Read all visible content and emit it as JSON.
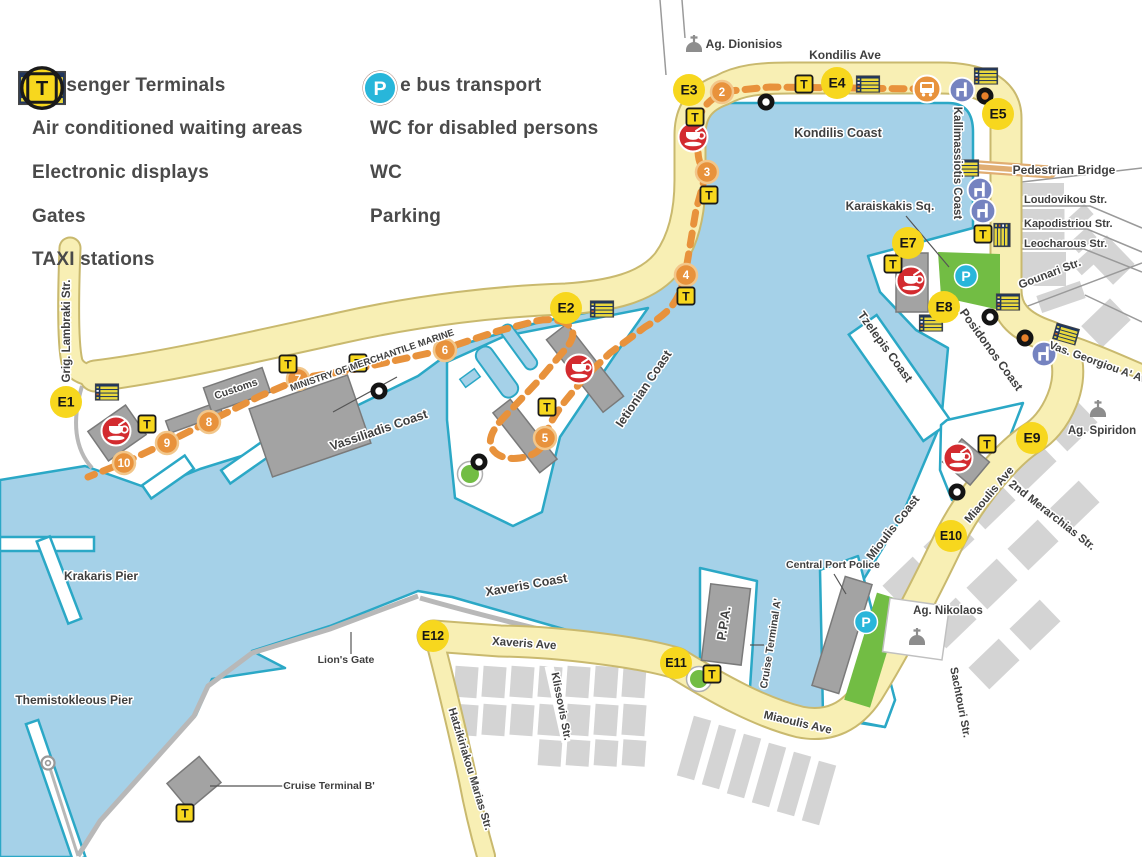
{
  "legend": {
    "left": [
      {
        "icon": "terminal",
        "label": "Passenger Terminals"
      },
      {
        "icon": "waiting",
        "label": "Air conditioned waiting areas"
      },
      {
        "icon": "display",
        "label": "Electronic displays"
      },
      {
        "icon": "gate",
        "label": "Gates"
      },
      {
        "icon": "taxi",
        "label": "TAXI stations"
      }
    ],
    "right": [
      {
        "icon": "bus",
        "label": "Free bus transport"
      },
      {
        "icon": "wc_disabled",
        "label": "WC for disabled persons"
      },
      {
        "icon": "wc",
        "label": "WC"
      },
      {
        "icon": "parking",
        "label": "Parking"
      }
    ],
    "gate_symbol": "E",
    "taxi_symbol": "T",
    "parking_symbol": "P"
  },
  "map": {
    "gates": [
      {
        "id": "E1",
        "x": 66,
        "y": 402
      },
      {
        "id": "E2",
        "x": 566,
        "y": 308
      },
      {
        "id": "E3",
        "x": 689,
        "y": 90
      },
      {
        "id": "E4",
        "x": 837,
        "y": 83
      },
      {
        "id": "E5",
        "x": 998,
        "y": 114
      },
      {
        "id": "E7",
        "x": 908,
        "y": 243
      },
      {
        "id": "E8",
        "x": 944,
        "y": 307
      },
      {
        "id": "E9",
        "x": 1032,
        "y": 438
      },
      {
        "id": "E10",
        "x": 951,
        "y": 536
      },
      {
        "id": "E11",
        "x": 676,
        "y": 663
      },
      {
        "id": "E12",
        "x": 433,
        "y": 636
      }
    ],
    "route_stops": [
      {
        "n": "2",
        "x": 722,
        "y": 92
      },
      {
        "n": "3",
        "x": 707,
        "y": 172
      },
      {
        "n": "4",
        "x": 686,
        "y": 275
      },
      {
        "n": "5",
        "x": 545,
        "y": 438
      },
      {
        "n": "6",
        "x": 445,
        "y": 350
      },
      {
        "n": "7",
        "x": 298,
        "y": 379
      },
      {
        "n": "8",
        "x": 209,
        "y": 422
      },
      {
        "n": "9",
        "x": 167,
        "y": 443
      },
      {
        "n": "10",
        "x": 124,
        "y": 463
      }
    ],
    "taxi_stations": [
      [
        804,
        84
      ],
      [
        695,
        117
      ],
      [
        709,
        195
      ],
      [
        686,
        296
      ],
      [
        288,
        364
      ],
      [
        358,
        363
      ],
      [
        147,
        424
      ],
      [
        547,
        407
      ],
      [
        983,
        234
      ],
      [
        893,
        264
      ],
      [
        987,
        444
      ],
      [
        712,
        674
      ],
      [
        185,
        813
      ]
    ],
    "displays": [
      [
        107,
        392,
        0
      ],
      [
        602,
        309,
        0
      ],
      [
        868,
        84,
        0
      ],
      [
        986,
        76,
        0
      ],
      [
        967,
        168,
        0
      ],
      [
        1002,
        235,
        90
      ],
      [
        931,
        323,
        0
      ],
      [
        1008,
        302,
        0
      ],
      [
        1066,
        334,
        16
      ]
    ],
    "passenger_terminals": [
      [
        693,
        137
      ],
      [
        579,
        369
      ],
      [
        116,
        431
      ],
      [
        911,
        281
      ],
      [
        958,
        458
      ]
    ],
    "waiting_areas": [
      [
        962,
        90
      ],
      [
        980,
        190
      ],
      [
        983,
        211
      ],
      [
        1044,
        354
      ]
    ],
    "wc": [
      [
        766,
        102
      ],
      [
        379,
        391
      ],
      [
        479,
        462
      ],
      [
        990,
        317
      ],
      [
        957,
        492
      ]
    ],
    "wc_disabled": [
      [
        985,
        96
      ],
      [
        1025,
        338
      ]
    ],
    "parking": [
      [
        966,
        276
      ],
      [
        866,
        622
      ]
    ],
    "free_bus": [
      [
        927,
        89
      ]
    ],
    "churches": [
      [
        694,
        47
      ],
      [
        1098,
        412
      ],
      [
        917,
        640
      ]
    ],
    "lighthouse": [
      [
        48,
        763
      ]
    ],
    "green_circles": [
      [
        470,
        474
      ],
      [
        699,
        679
      ]
    ],
    "labels": [
      {
        "t": "Ag. Dionisios",
        "x": 744,
        "y": 48,
        "s": 12
      },
      {
        "t": "Kondilis Ave",
        "x": 845,
        "y": 59,
        "s": 12
      },
      {
        "t": "Kondilis Coast",
        "x": 838,
        "y": 137,
        "s": 12.5
      },
      {
        "t": "Kallimassiotis Coast",
        "x": 954,
        "y": 163,
        "r": 90,
        "s": 11.5
      },
      {
        "t": "Pedestrian Bridge",
        "x": 1064,
        "y": 174,
        "s": 12
      },
      {
        "t": "Loudovikou Str.",
        "x": 1024,
        "y": 203,
        "s": 11,
        "a": "start"
      },
      {
        "t": "Kapodistriou Str.",
        "x": 1024,
        "y": 227,
        "s": 11,
        "a": "start"
      },
      {
        "t": "Leocharous Str.",
        "x": 1024,
        "y": 247,
        "s": 11,
        "a": "start"
      },
      {
        "t": "Karaiskakis Sq.",
        "x": 890,
        "y": 210,
        "s": 12
      },
      {
        "t": "Gounari Str.",
        "x": 1051,
        "y": 277,
        "r": -21,
        "s": 11.5
      },
      {
        "t": "Tzelepis Coast",
        "x": 882,
        "y": 349,
        "r": 54,
        "s": 12
      },
      {
        "t": "Posidonos Coast",
        "x": 988,
        "y": 352,
        "r": 54,
        "s": 12
      },
      {
        "t": "Vas. Georgiou A' Av.",
        "x": 1098,
        "y": 366,
        "r": 20,
        "s": 11
      },
      {
        "t": "Ag. Spiridon",
        "x": 1102,
        "y": 434,
        "s": 11.5
      },
      {
        "t": "Grig. Lambraki Str.",
        "x": 70,
        "y": 331,
        "r": -90,
        "s": 11.5
      },
      {
        "t": "Customs",
        "x": 237,
        "y": 392,
        "r": -19,
        "s": 10.5
      },
      {
        "t": "MINISTRY OF MERCHANTILE MARINE",
        "x": 373,
        "y": 363,
        "r": -19,
        "s": 9.5
      },
      {
        "t": "Vassiliadis Coast",
        "x": 380,
        "y": 434,
        "r": -19,
        "s": 12.5
      },
      {
        "t": "Ietionian Coast",
        "x": 647,
        "y": 391,
        "r": -56,
        "s": 12.5
      },
      {
        "t": "Mioulis Coast",
        "x": 896,
        "y": 530,
        "r": -52,
        "s": 12
      },
      {
        "t": "Miaoulis Ave",
        "x": 992,
        "y": 497,
        "r": -50,
        "s": 11.5
      },
      {
        "t": "2nd Merarchias Str.",
        "x": 1050,
        "y": 518,
        "r": 38,
        "s": 11.5
      },
      {
        "t": "Central Port Police",
        "x": 833,
        "y": 568,
        "s": 10.5
      },
      {
        "t": "Ag. Nikolaos",
        "x": 948,
        "y": 614,
        "s": 11.5
      },
      {
        "t": "Sachtouri Str.",
        "x": 957,
        "y": 703,
        "r": 79,
        "s": 11
      },
      {
        "t": "Krakaris Pier",
        "x": 101,
        "y": 580,
        "s": 12
      },
      {
        "t": "Themistokleous Pier",
        "x": 74,
        "y": 704,
        "s": 12
      },
      {
        "t": "Lion's Gate",
        "x": 346,
        "y": 663,
        "s": 10.5
      },
      {
        "t": "Cruise Terminal B'",
        "x": 329,
        "y": 789,
        "s": 10.5
      },
      {
        "t": "Cruise Terminal A'",
        "x": 774,
        "y": 644,
        "r": -81,
        "s": 10.5
      },
      {
        "t": "P.P.A.",
        "x": 728,
        "y": 624,
        "r": -81,
        "s": 13,
        "w": 700
      },
      {
        "t": "Xaveris Coast",
        "x": 527,
        "y": 589,
        "r": -10,
        "s": 12.5
      },
      {
        "t": "Xaveris Ave",
        "x": 524,
        "y": 647,
        "r": 4,
        "s": 11.5
      },
      {
        "t": "Miaoulis Ave",
        "x": 797,
        "y": 726,
        "r": 13,
        "s": 11.5
      },
      {
        "t": "Hatzikiriakou Marias Str.",
        "x": 467,
        "y": 770,
        "r": 73,
        "s": 11
      },
      {
        "t": "Klissovis Str.",
        "x": 558,
        "y": 707,
        "r": 79,
        "s": 11
      }
    ],
    "leader_lines": [
      [
        906,
        216,
        949,
        267
      ],
      [
        834,
        574,
        846,
        594
      ],
      [
        764,
        645,
        750,
        645
      ],
      [
        288,
        786,
        210,
        786
      ],
      [
        351,
        654,
        351,
        632
      ],
      [
        397,
        377,
        333,
        412
      ]
    ]
  },
  "colors": {
    "water": "#a5d1e8",
    "coast": "#2ba8c6",
    "road": "#f8efb4",
    "road_edge": "#c9b96e",
    "route": "#e8923c",
    "gate_yellow": "#f7d71e",
    "terminal_red": "#d32b2f",
    "waiting_blue": "#7583c0",
    "parking_cyan": "#28b6da",
    "bus_brown": "#8a5a4c",
    "green": "#72bd44",
    "building": "#a3a3a3",
    "block": "#d4d4d4",
    "label": "#3f3f3f",
    "display_dark": "#20365c",
    "display_yellow": "#ead83e"
  }
}
